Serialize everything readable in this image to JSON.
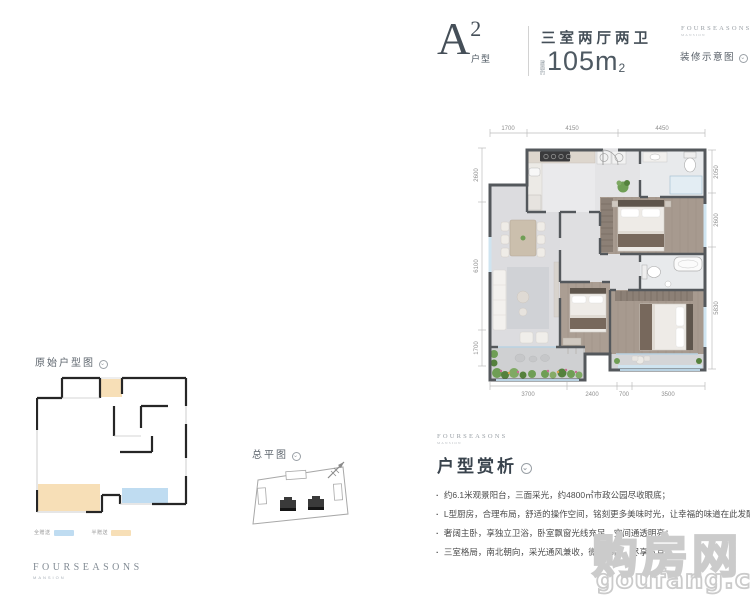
{
  "header": {
    "unit_letter": "A",
    "unit_sup": "2",
    "unit_label": "户型",
    "rooms": "三室两厅两卫",
    "area_prefix": "建面约",
    "area_value": "105m",
    "area_sup": "2",
    "brand_name": "FOURSEASONS",
    "brand_sub": "MANSION",
    "deco_note": "装修示意图"
  },
  "floor_plan": {
    "dims_top": [
      "1700",
      "4150",
      "4450"
    ],
    "dims_bottom": [
      "3700",
      "2400",
      "700",
      "3500"
    ],
    "dims_left": [
      "2600",
      "6100",
      "1700"
    ],
    "dims_right": [
      "2050",
      "2600",
      "5830"
    ]
  },
  "original_plan": {
    "title": "原始户型图",
    "legend": [
      {
        "label": "全赠送",
        "color": "#bfdcf1"
      },
      {
        "label": "半赠送",
        "color": "#f7dfb7"
      }
    ]
  },
  "site_plan": {
    "title": "总平图"
  },
  "analysis": {
    "brand_name": "FOURSEASONS",
    "brand_sub": "MANSION",
    "title": "户型赏析",
    "bullets": [
      "约6.1米观景阳台，三面采光，约4800㎡市政公园尽收眼底；",
      "L型厨房，合理布局，舒适的操作空间，铭刻更多美味时光，让幸福的味道在此发酵；",
      "奢阔主卧，享独立卫浴，卧室飘窗光线充足，空间通透明亮；",
      "三室格局，南北朝向，采光通风兼收，微风拂面，尽享写意；"
    ]
  },
  "watermark": {
    "cn": "购房网",
    "en": "goufang.com"
  },
  "icons": {
    "circle_chevron": "⌄"
  },
  "colors": {
    "accent_dark": "#454f58",
    "wall": "#54585c",
    "wood_floor": "#a79a8f",
    "window_blue": "#cfe4f0",
    "plant_green": "#6f9e55",
    "legend_blue": "#bfdcf1",
    "legend_orange": "#f7dfb7",
    "watermark_gray": "#cbcbcb"
  }
}
